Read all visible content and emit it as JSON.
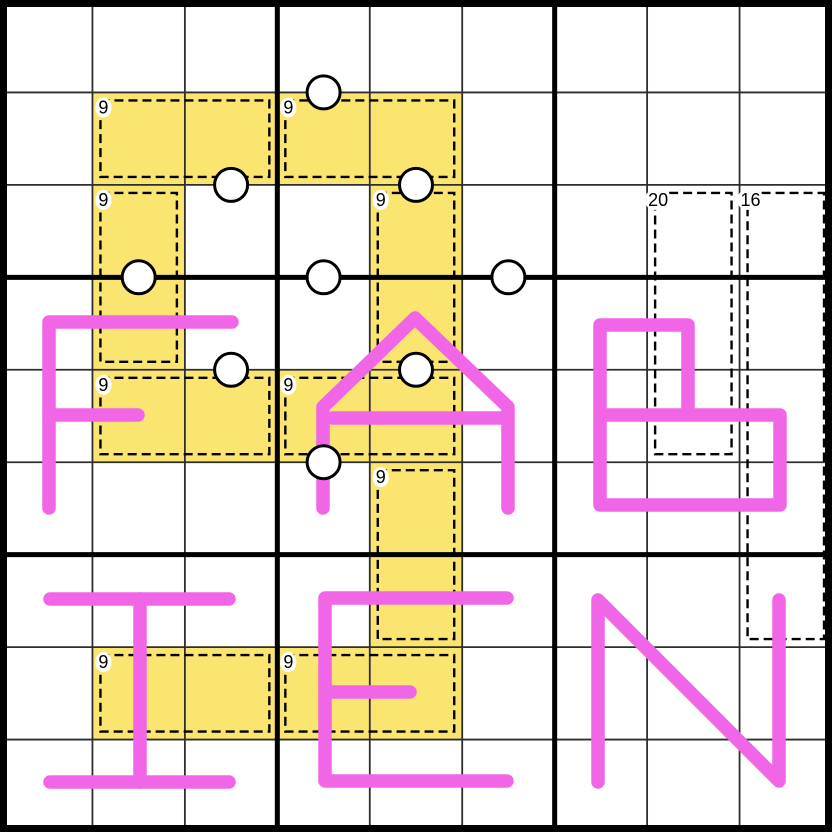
{
  "board": {
    "size_px": 832,
    "rows": 9,
    "cols": 9,
    "box_size": 3,
    "word_overlay": "FABIEN"
  },
  "colors": {
    "background": "#FFFFFF",
    "cage_highlight": "#FBE571",
    "letter": "#F066E6",
    "grid_thin": "#2E2E2E",
    "grid_thick": "#000000",
    "cage_dash": "#000000",
    "dot_fill": "#FFFFFF",
    "dot_stroke": "#000000",
    "label_text": "#000000",
    "label_bg": "#FFFFFF"
  },
  "cages": [
    {
      "label": "9",
      "highlighted": true,
      "cells": [
        [
          2,
          2
        ],
        [
          2,
          3
        ]
      ]
    },
    {
      "label": "9",
      "highlighted": true,
      "cells": [
        [
          2,
          4
        ],
        [
          2,
          5
        ]
      ]
    },
    {
      "label": "9",
      "highlighted": true,
      "cells": [
        [
          3,
          2
        ],
        [
          4,
          2
        ]
      ]
    },
    {
      "label": "9",
      "highlighted": true,
      "cells": [
        [
          3,
          5
        ],
        [
          4,
          5
        ]
      ]
    },
    {
      "label": "9",
      "highlighted": true,
      "cells": [
        [
          5,
          2
        ],
        [
          5,
          3
        ]
      ]
    },
    {
      "label": "9",
      "highlighted": true,
      "cells": [
        [
          5,
          4
        ],
        [
          5,
          5
        ]
      ]
    },
    {
      "label": "9",
      "highlighted": true,
      "cells": [
        [
          6,
          5
        ],
        [
          7,
          5
        ]
      ]
    },
    {
      "label": "9",
      "highlighted": true,
      "cells": [
        [
          8,
          2
        ],
        [
          8,
          3
        ]
      ]
    },
    {
      "label": "9",
      "highlighted": true,
      "cells": [
        [
          8,
          4
        ],
        [
          8,
          5
        ]
      ]
    },
    {
      "label": "20",
      "highlighted": false,
      "cells": [
        [
          3,
          8
        ],
        [
          4,
          8
        ],
        [
          5,
          8
        ]
      ]
    },
    {
      "label": "16",
      "highlighted": false,
      "cells": [
        [
          3,
          9
        ],
        [
          4,
          9
        ],
        [
          5,
          9
        ],
        [
          6,
          9
        ],
        [
          7,
          9
        ]
      ]
    }
  ],
  "dots": [
    {
      "cx": 323.6,
      "cy": 92.4,
      "edge": "r1c4-r2c4"
    },
    {
      "cx": 231.1,
      "cy": 184.9,
      "edge": "r2c3-r3c3"
    },
    {
      "cx": 416.0,
      "cy": 184.9,
      "edge": "r2c5-r3c5"
    },
    {
      "cx": 138.7,
      "cy": 277.3,
      "edge": "r3c2-r4c2"
    },
    {
      "cx": 323.6,
      "cy": 277.3,
      "edge": "r3c4-r4c4"
    },
    {
      "cx": 508.4,
      "cy": 277.3,
      "edge": "r3c6-r4c6"
    },
    {
      "cx": 231.1,
      "cy": 369.8,
      "edge": "r4c3-r5c3"
    },
    {
      "cx": 416.0,
      "cy": 369.8,
      "edge": "r4c5-r5c5"
    },
    {
      "cx": 323.6,
      "cy": 462.2,
      "edge": "r5c4-r6c4"
    }
  ],
  "letters": [
    {
      "char": "F",
      "strokes": [
        [
          [
            232,
            322
          ],
          [
            49,
            322
          ],
          [
            49,
            508
          ]
        ],
        [
          [
            49,
            415
          ],
          [
            138,
            415
          ]
        ]
      ]
    },
    {
      "char": "A",
      "strokes": [
        [
          [
            323,
            508
          ],
          [
            323,
            407
          ],
          [
            415,
            318
          ],
          [
            508,
            407
          ],
          [
            508,
            508
          ]
        ],
        [
          [
            333,
            418
          ],
          [
            506,
            418
          ]
        ]
      ]
    },
    {
      "char": "B",
      "strokes": [
        [
          [
            688,
            407
          ],
          [
            688,
            325
          ],
          [
            600,
            325
          ],
          [
            600,
            505
          ],
          [
            780,
            505
          ],
          [
            780,
            415
          ],
          [
            600,
            415
          ]
        ]
      ]
    },
    {
      "char": "I",
      "strokes": [
        [
          [
            50,
            599
          ],
          [
            229,
            599
          ]
        ],
        [
          [
            140,
            599
          ],
          [
            140,
            782
          ]
        ],
        [
          [
            50,
            782
          ],
          [
            229,
            782
          ]
        ]
      ]
    },
    {
      "char": "E",
      "strokes": [
        [
          [
            507,
            598
          ],
          [
            325,
            598
          ],
          [
            325,
            781
          ],
          [
            507,
            781
          ]
        ],
        [
          [
            325,
            692
          ],
          [
            410,
            692
          ]
        ]
      ]
    },
    {
      "char": "N",
      "strokes": [
        [
          [
            598,
            782
          ],
          [
            598,
            600
          ],
          [
            779,
            781
          ],
          [
            779,
            600
          ]
        ]
      ]
    }
  ],
  "style": {
    "letter_stroke_width": 13.5,
    "dot_radius": 16.5,
    "dot_stroke_width": 3,
    "cage_inset": 8,
    "cage_dash_pattern": "9 5",
    "cage_dash_width": 2.4,
    "grid_thin_width": 1.8,
    "grid_thick_width": 5,
    "outer_border_width": 7,
    "label_font_size": 18
  }
}
